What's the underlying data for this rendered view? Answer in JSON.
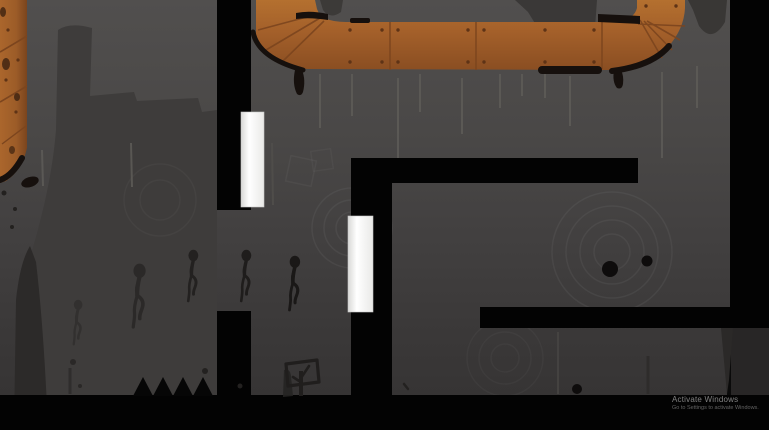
{
  "watermark": {
    "line1": "Activate Windows",
    "line2": "Go to Settings to activate Windows."
  },
  "scene": {
    "type": "2d-silhouette-platformer-level",
    "colors": {
      "pipe_orange": "#a4602a",
      "pipe_seam": "#7c451e",
      "pipe_rim_black": "#16100d",
      "background_top": "#514f4e",
      "background_bottom": "#343232",
      "cliff_silhouette": "#3e3c3b",
      "structure_black": "#030303",
      "door_white": "#ffffff",
      "runner_silhouette": "#1a1817"
    },
    "entities": {
      "doors_count": 2,
      "ghost_runners_count": 5,
      "floor_spikes_count": 4,
      "signpost_glyph": "check-mark",
      "ink_dots_count": 2
    }
  }
}
